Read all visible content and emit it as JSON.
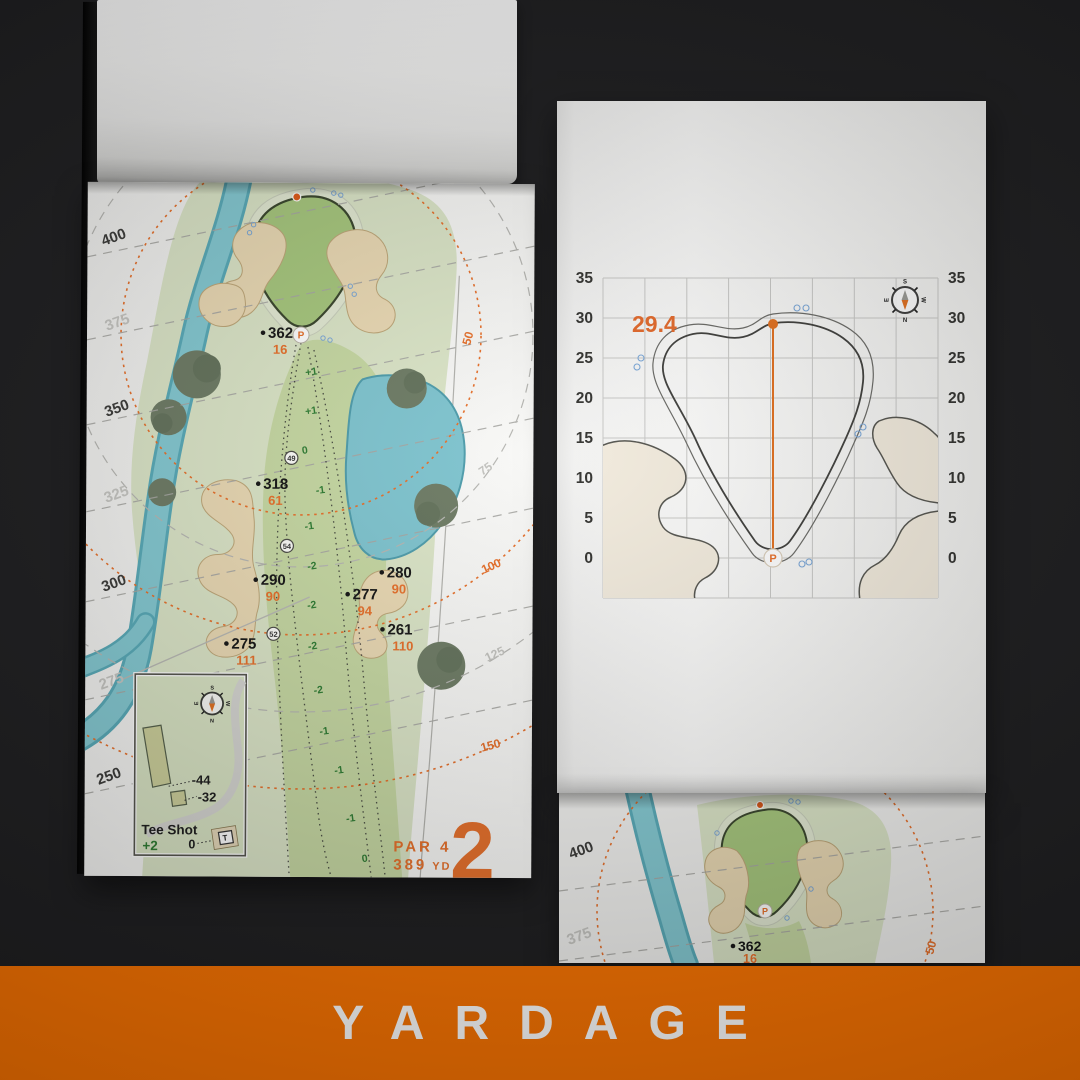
{
  "banner": {
    "label": "YARDAGE",
    "bg_color": "#FA7300"
  },
  "compass": {
    "n": "N",
    "s": "S",
    "e": "E",
    "w": "W"
  },
  "colors": {
    "accent_orange": "#E8702A",
    "rough_green": "#DCE6C8",
    "fairway_green": "#C7D9A3",
    "putting_green": "#A7C87D",
    "sand": "#EBDAB4",
    "water": "#7FC5D0",
    "tree_green": "#6E7C65",
    "slope_number_green": "#2F7D33",
    "sprinkler_blue": "#7AA7D8"
  },
  "left_page": {
    "hole_number": "2",
    "par_label": "PAR 4",
    "yards_value": "389",
    "yards_unit": "YD",
    "tee_distances": [
      "400",
      "375",
      "350",
      "325",
      "300",
      "275",
      "250"
    ],
    "arc_distances": [
      "50",
      "75",
      "100",
      "125",
      "150"
    ],
    "markers": [
      {
        "carry": "362",
        "remain": "16"
      },
      {
        "carry": "318",
        "remain": "61"
      },
      {
        "carry": "290",
        "remain": "90"
      },
      {
        "carry": "280",
        "remain": "90"
      },
      {
        "carry": "277",
        "remain": "94"
      },
      {
        "carry": "261",
        "remain": "110"
      },
      {
        "carry": "275",
        "remain": "111"
      }
    ],
    "slope_numbers": [
      "+1",
      "+1",
      "0",
      "-1",
      "-1",
      "-2",
      "-2",
      "-2",
      "-2",
      "-1",
      "-1",
      "-1",
      "0"
    ],
    "waypoints": [
      "49",
      "54",
      "52"
    ],
    "pin": "P",
    "tee_inset": {
      "title": "Tee Shot",
      "score": "+2",
      "offset_long": "-44",
      "offset_short": "-32",
      "zero": "0",
      "tee": "T"
    }
  },
  "right_page": {
    "depth": "29.4",
    "ticks": [
      "35",
      "30",
      "25",
      "20",
      "15",
      "10",
      "5",
      "0"
    ],
    "pin": "P"
  },
  "under_page": {
    "tee_distances": [
      "400",
      "375"
    ],
    "marker": {
      "carry": "362",
      "remain": "16"
    },
    "arc_distance": "50"
  }
}
